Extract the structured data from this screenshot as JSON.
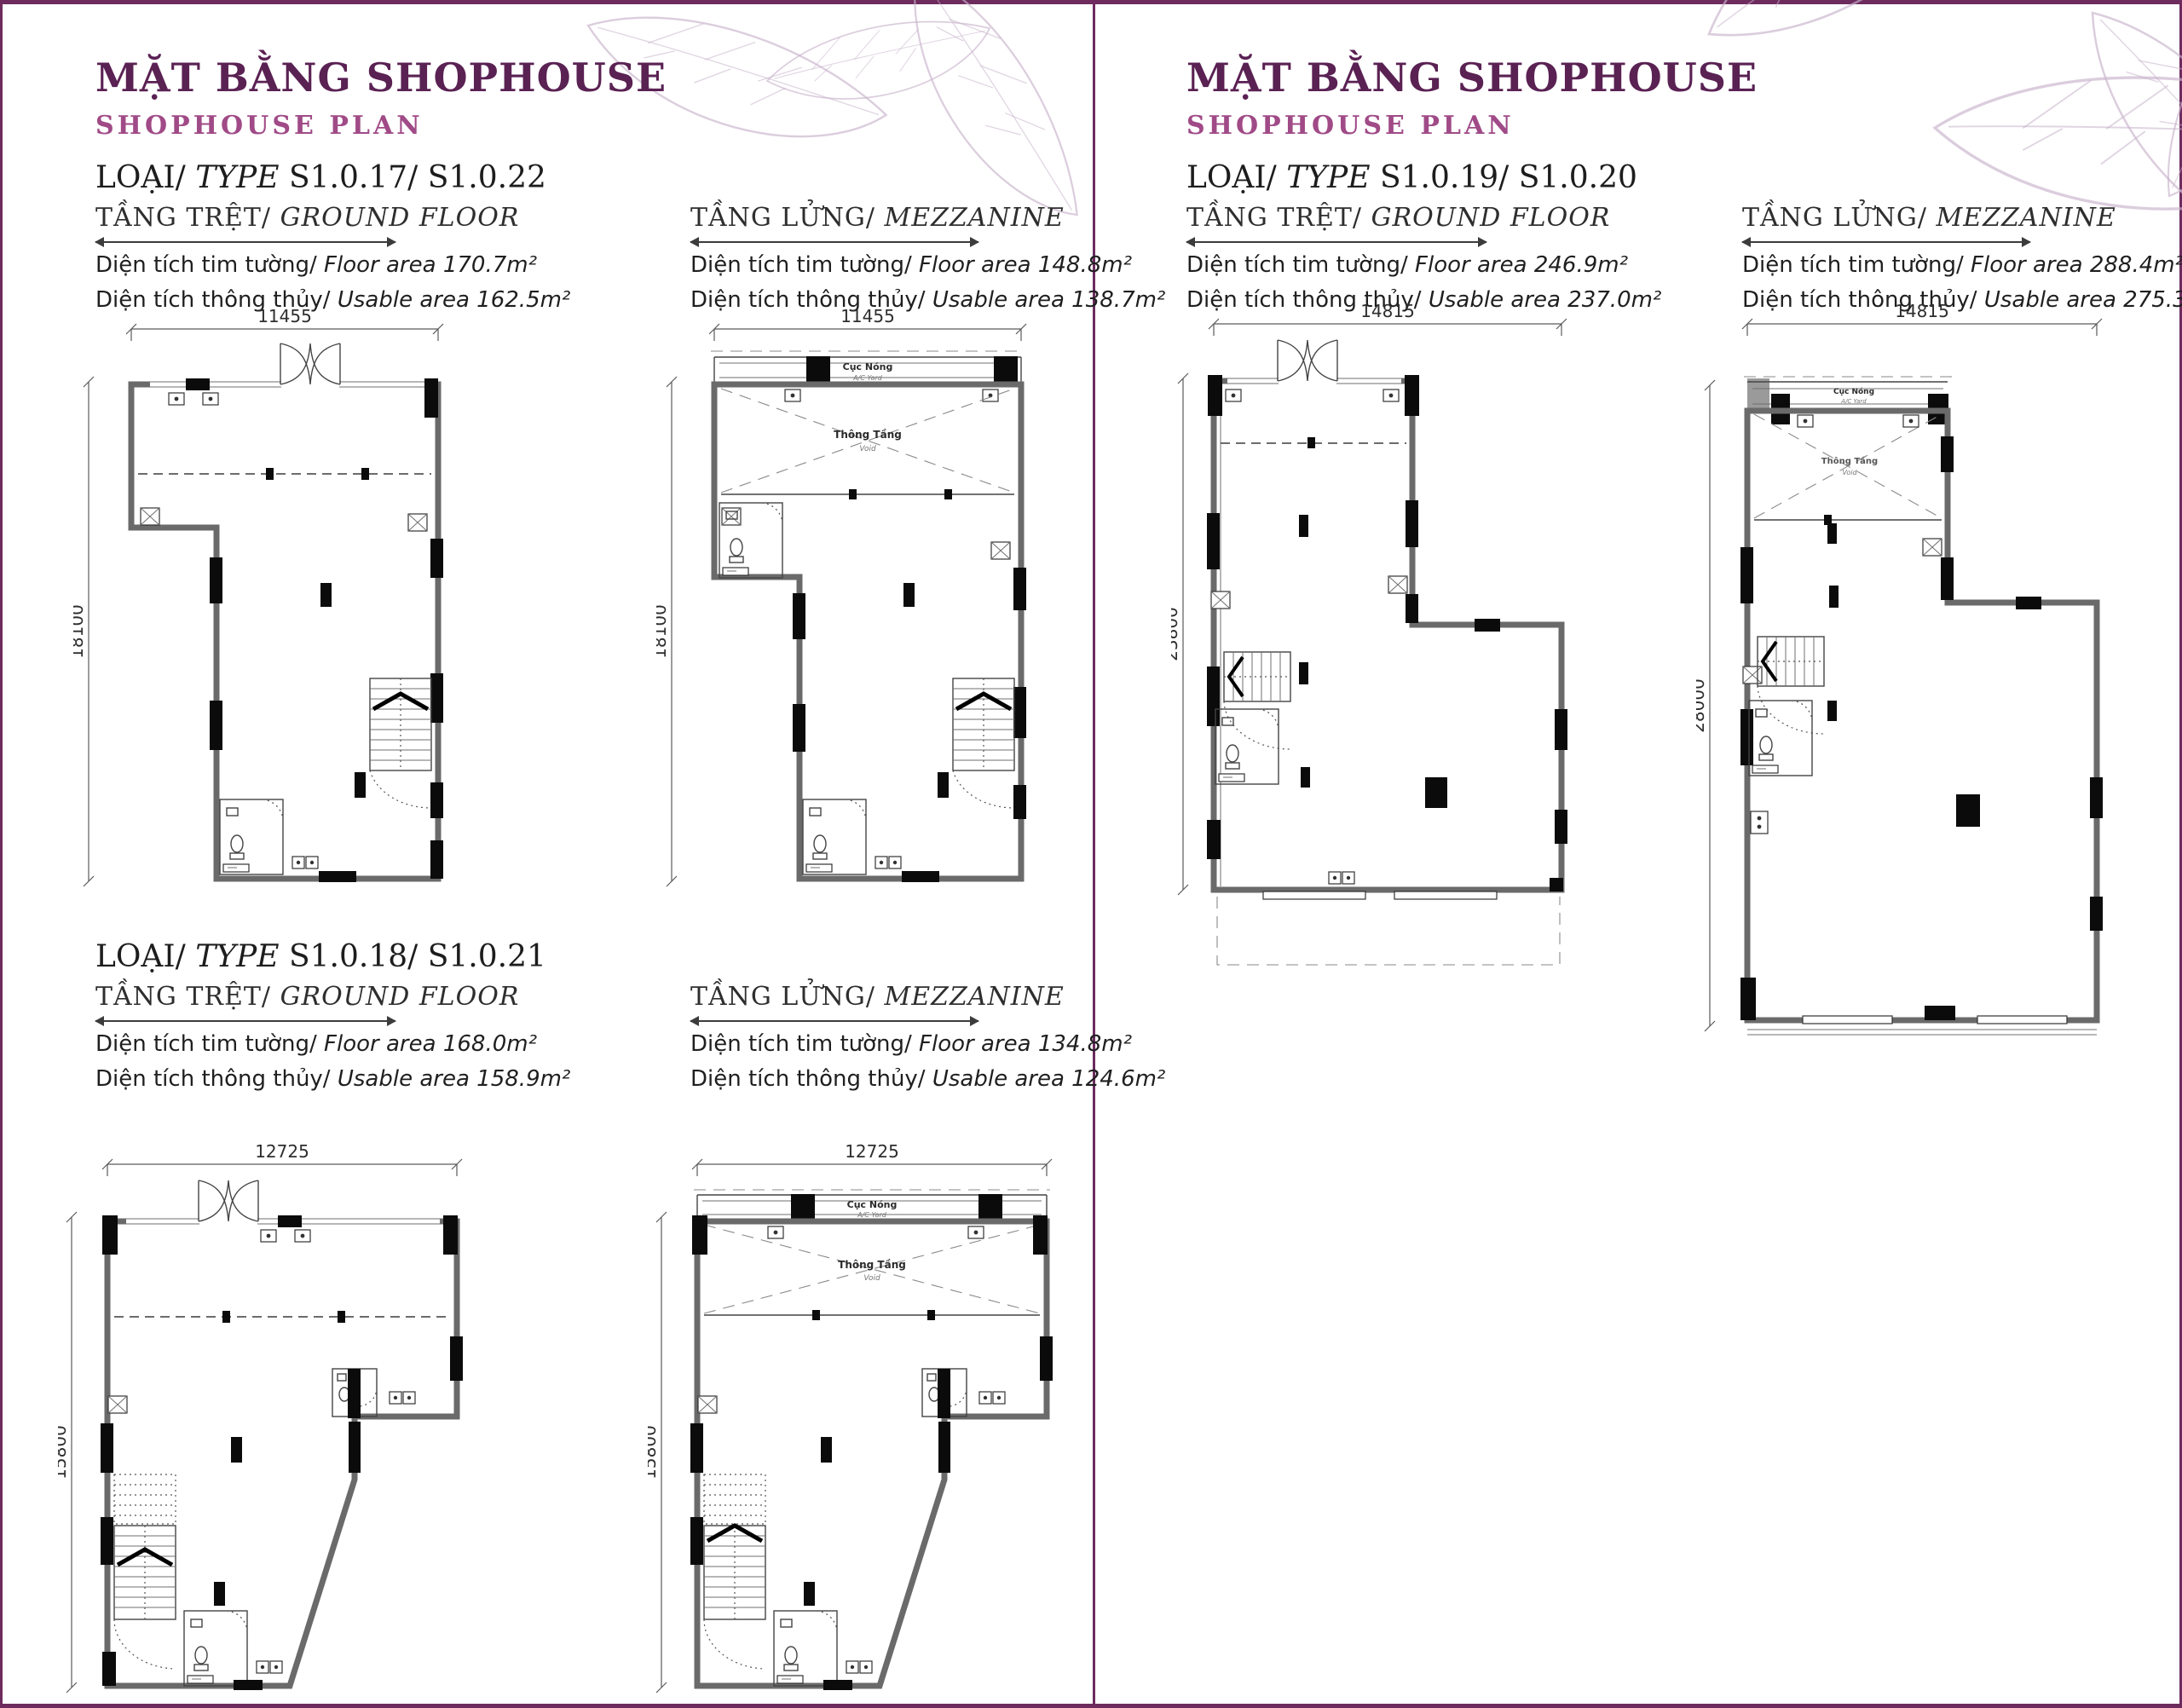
{
  "colors": {
    "title_purple": "#5a2153",
    "subtitle_purple": "#a04a87",
    "frame_purple": "#6d2b5e"
  },
  "labels": {
    "title_vi": "MẶT BẰNG SHOPHOUSE",
    "title_en": "SHOPHOUSE PLAN",
    "loai": "LOẠI/",
    "type_word": "TYPE",
    "ground_vi": "TẦNG TRỆT/",
    "ground_en": "GROUND FLOOR",
    "mezz_vi": "TẦNG LỬNG/",
    "mezz_en": "MEZZANINE",
    "floor_area_vi": "Diện tích tim tường/",
    "floor_area_en": "Floor area",
    "usable_vi": "Diện tích thông thủy/",
    "usable_en": "Usable area",
    "ac_vi": "Cục Nóng",
    "ac_en": "A/C Yard",
    "void_vi": "Thông Tầng",
    "void_en": "Void"
  },
  "sections": {
    "s17": {
      "type_codes": "S1.0.17/ S1.0.22",
      "ground": {
        "floor_area": "170.7m²",
        "usable_area": "162.5m²",
        "width_dim": "11455",
        "height_dim": "18100"
      },
      "mezz": {
        "floor_area": "148.8m²",
        "usable_area": "138.7m²",
        "width_dim": "11455",
        "height_dim": "18100"
      }
    },
    "s18": {
      "type_codes": "S1.0.18/ S1.0.21",
      "ground": {
        "floor_area": "168.0m²",
        "usable_area": "158.9m²",
        "width_dim": "12725",
        "height_dim": "15800"
      },
      "mezz": {
        "floor_area": "134.8m²",
        "usable_area": "124.6m²",
        "width_dim": "12725",
        "height_dim": "15800"
      }
    },
    "s19": {
      "type_codes": "S1.0.19/ S1.0.20",
      "ground": {
        "floor_area": "246.9m²",
        "usable_area": "237.0m²",
        "width_dim": "14815",
        "height_dim": "23800"
      },
      "mezz": {
        "floor_area": "288.4m²",
        "usable_area": "275.3m²",
        "width_dim": "14815",
        "height_dim": "28000"
      }
    }
  }
}
